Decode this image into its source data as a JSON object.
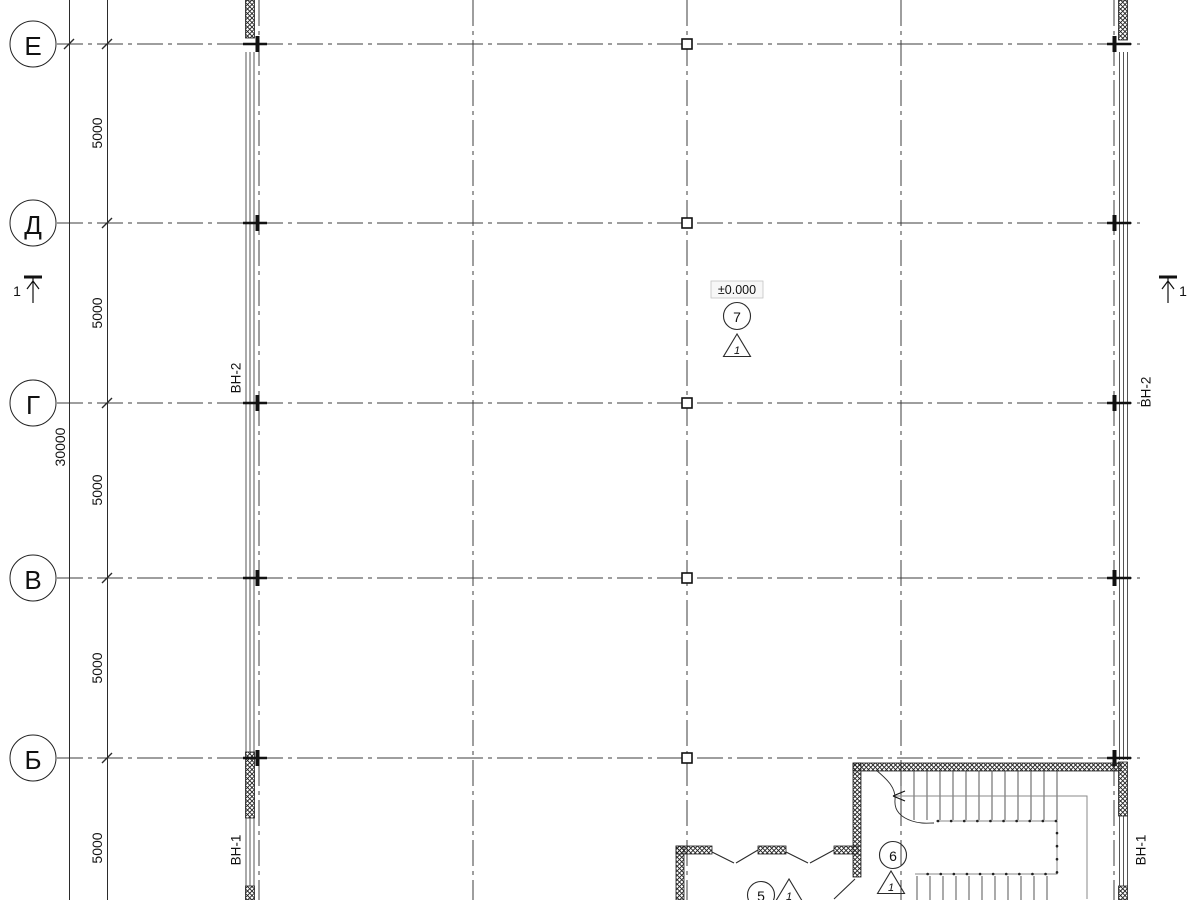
{
  "grid": {
    "rows": [
      {
        "label": "Е"
      },
      {
        "label": "Д"
      },
      {
        "label": "Г"
      },
      {
        "label": "В"
      },
      {
        "label": "Б"
      }
    ],
    "segment_dims": [
      "5000",
      "5000",
      "5000",
      "5000",
      "5000"
    ],
    "total_dim": "30000"
  },
  "elevation": {
    "value": "±0.000"
  },
  "markers": {
    "m7": {
      "number": "7",
      "floor_type": "1"
    },
    "m6": {
      "number": "6",
      "floor_type": "1"
    },
    "m5": {
      "number": "5",
      "floor_type": "1"
    }
  },
  "sections": {
    "left": {
      "label": "1"
    },
    "right": {
      "label": "1"
    }
  },
  "windows": {
    "left_top": {
      "label": "ВН-2"
    },
    "left_bottom": {
      "label": "ВН-1"
    },
    "right_top": {
      "label": "ВН-2"
    },
    "right_bottom": {
      "label": "ВН-1"
    }
  },
  "colors": {
    "background": "#ffffff",
    "line": "#2b2b2b",
    "axis": "#3c3c3c",
    "hatch_wall": "#1f1f1f",
    "railing_gray": "#8a8a8a",
    "elevation_box_bg": "#f7f7f7",
    "elevation_box_border": "#c4c4c4"
  }
}
